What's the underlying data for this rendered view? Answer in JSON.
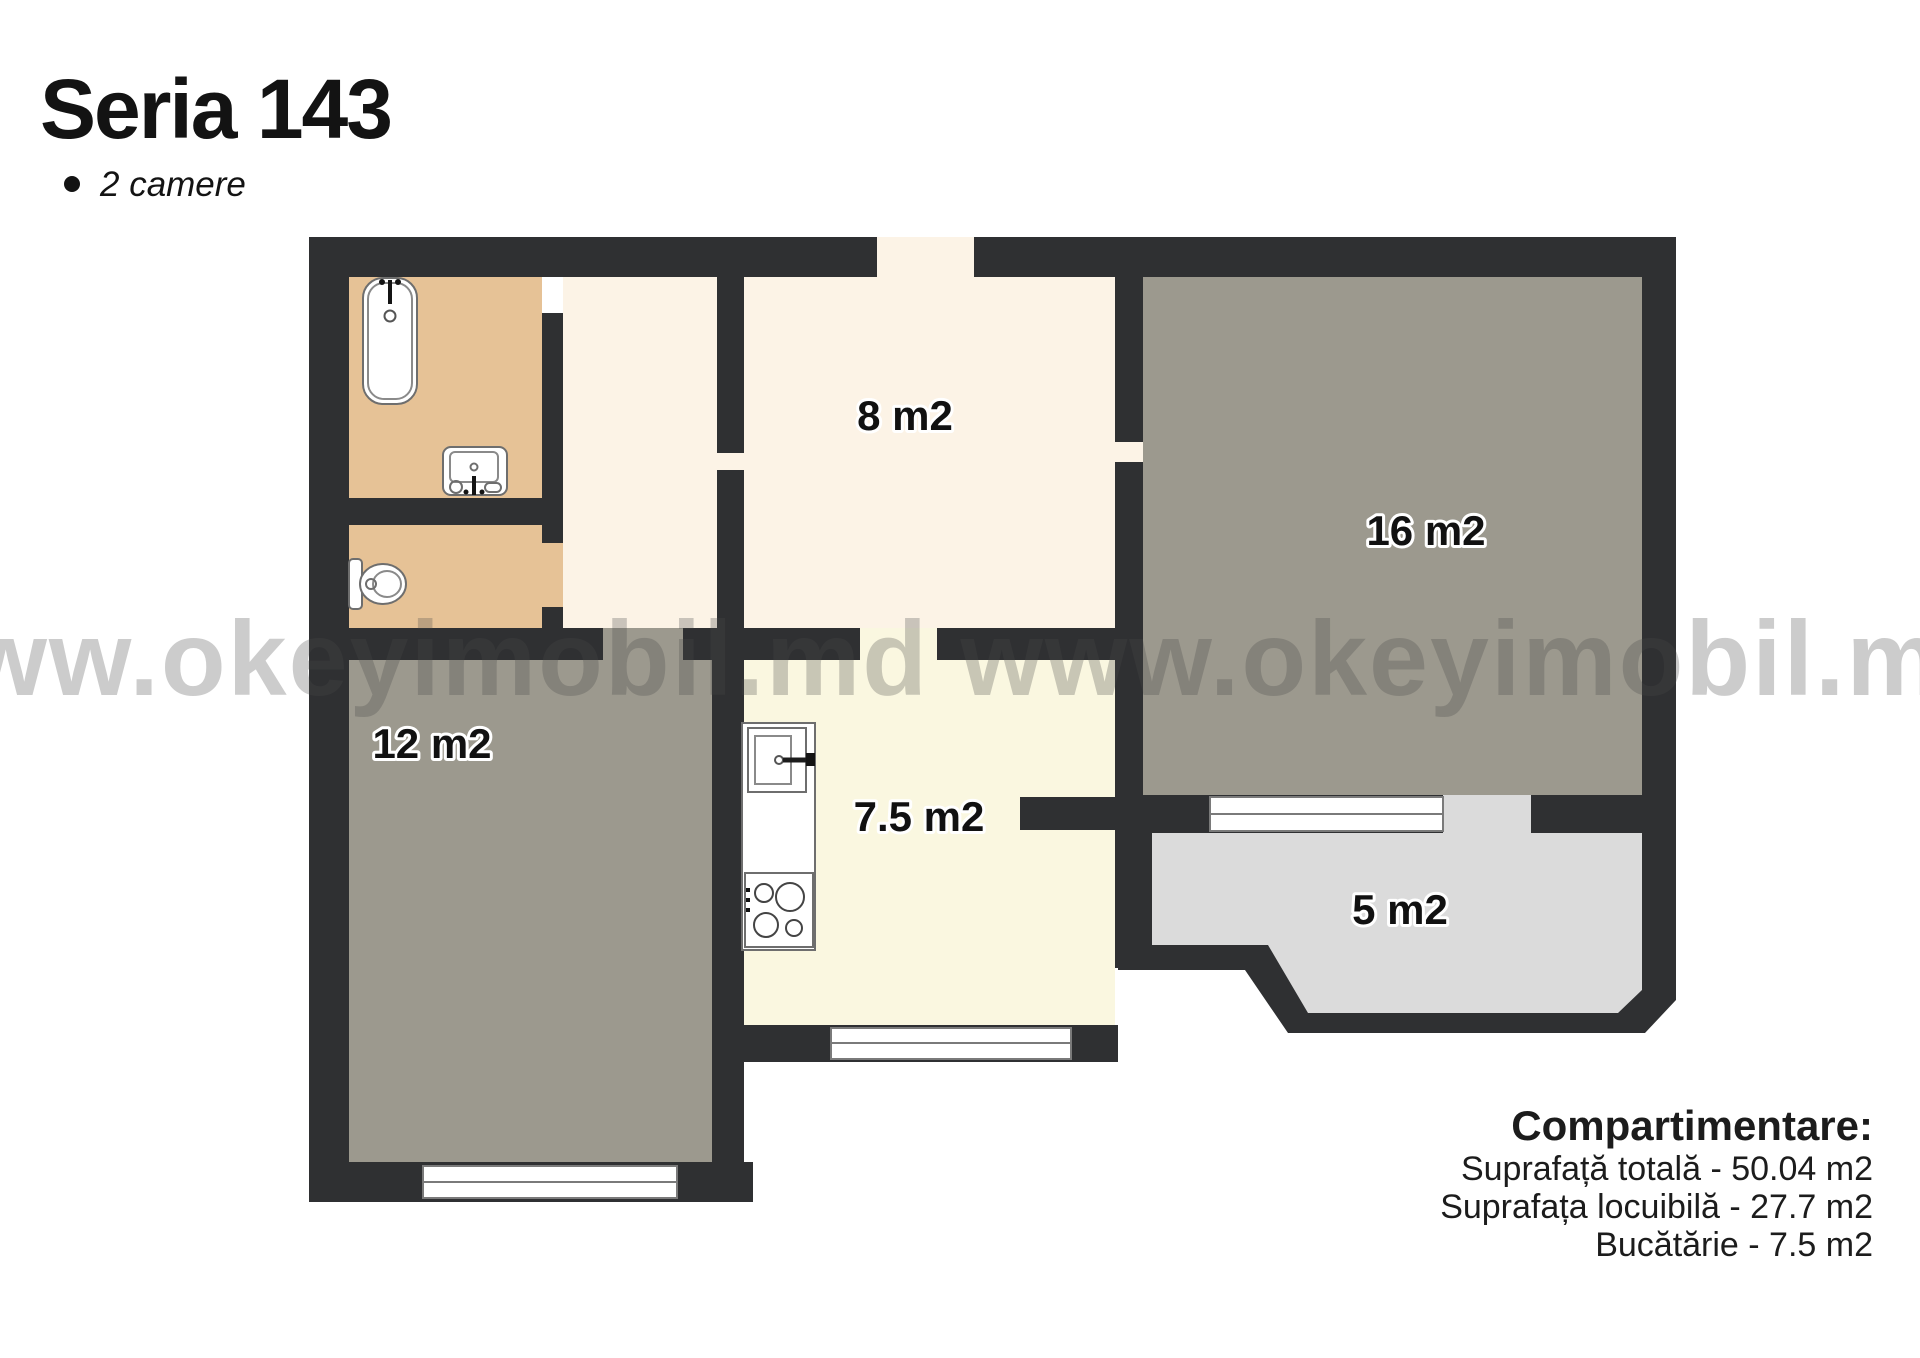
{
  "header": {
    "title": "Seria 143",
    "subtitle": "2 camere"
  },
  "watermark": {
    "text": "www.okeyimobil.md www.okeyimobil.md"
  },
  "rooms": {
    "hallway": {
      "label": "8 m2"
    },
    "living": {
      "label": "16 m2"
    },
    "bedroom": {
      "label": "12 m2"
    },
    "kitchen": {
      "label": "7.5 m2"
    },
    "balcony": {
      "label": "5 m2"
    }
  },
  "summary": {
    "title": "Compartimentare:",
    "lines": [
      "Suprafață totală - 50.04 m2",
      "Suprafața locuibilă - 27.7 m2",
      "Bucătărie - 7.5 m2"
    ]
  },
  "fixtures": [
    "bathtub",
    "bathroom-sink",
    "toilet",
    "kitchen-counter",
    "kitchen-sink",
    "stove"
  ],
  "colors": {
    "wall": "#2f3032",
    "bathroom_floor": "#e6c296",
    "hall_floor": "#fcf3e6",
    "kitchen_floor": "#faf7e0",
    "room_floor": "#9c998e",
    "balcony_floor": "#dbdbdb",
    "background": "#ffffff",
    "label_text": "#111111",
    "heading_text": "#131313",
    "watermark": "#4a4a4a"
  }
}
